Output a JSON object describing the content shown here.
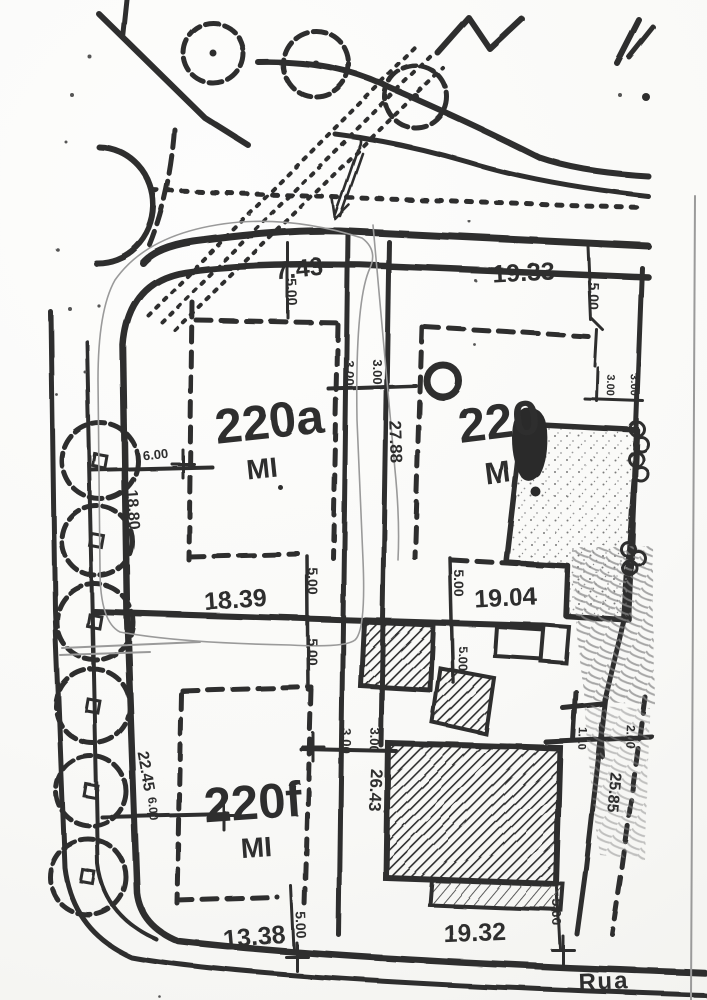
{
  "meta": {
    "document_type": "Scanned cadastral site plan",
    "street_label": "Rua"
  },
  "colors": {
    "ink": "#2f2f2f",
    "paper": "#f9f9f7",
    "pencil": "#9a9a9a"
  },
  "plots": [
    {
      "id": "220a",
      "zoning": "MI"
    },
    {
      "id": "220",
      "zoning": "M"
    },
    {
      "id": "220f",
      "zoning": "MI"
    }
  ],
  "dimensions_m": {
    "top_frontages": [
      "7.43",
      "19.33"
    ],
    "mid_frontages": [
      "18.39",
      "19.04"
    ],
    "bottom_frontages": [
      "13.38",
      "19.32"
    ],
    "left_boundary": [
      "18.80",
      "22.45"
    ],
    "road_centerline": [
      "27.88",
      "26.43"
    ],
    "right_side": [
      "25.85",
      "1.10",
      "2.00"
    ],
    "setbacks": [
      "5.00",
      "3.00",
      "6.00"
    ]
  },
  "labels": [
    {
      "name": "dim-7-43",
      "text": "7.43",
      "x": 300,
      "y": 277,
      "rot": -6,
      "size": 25
    },
    {
      "name": "dim-19-33",
      "text": "19.33",
      "x": 524,
      "y": 281,
      "rot": -3,
      "size": 25
    },
    {
      "name": "setback-5-00-top-left",
      "text": "5.00",
      "x": 287,
      "y": 292,
      "rot": 88,
      "size": 14
    },
    {
      "name": "setback-5-00-top-right",
      "text": "5.00",
      "x": 589,
      "y": 296,
      "rot": 92,
      "size": 14
    },
    {
      "name": "setback-3-00-top-a",
      "text": "3.00",
      "x": 345,
      "y": 373,
      "rot": 90,
      "size": 13
    },
    {
      "name": "setback-3-00-top-b",
      "text": "3.00",
      "x": 373,
      "y": 372,
      "rot": 90,
      "size": 13
    },
    {
      "name": "setback-3-00-right-a",
      "text": "3.00",
      "x": 607,
      "y": 385,
      "rot": 92,
      "size": 11
    },
    {
      "name": "setback-3-00-right-b",
      "text": "3.00",
      "x": 631,
      "y": 385,
      "rot": 92,
      "size": 11
    },
    {
      "name": "dim-27-88",
      "text": "27.88",
      "x": 390,
      "y": 442,
      "rot": 88,
      "size": 17
    },
    {
      "name": "dim-6-00-upper",
      "text": "6.00",
      "x": 156,
      "y": 459,
      "rot": -6,
      "size": 13
    },
    {
      "name": "dim-18-80",
      "text": "18.80",
      "x": 128,
      "y": 510,
      "rot": 86,
      "size": 16
    },
    {
      "name": "dim-18-39",
      "text": "18.39",
      "x": 236,
      "y": 608,
      "rot": -4,
      "size": 25
    },
    {
      "name": "dim-19-04",
      "text": "19.04",
      "x": 506,
      "y": 606,
      "rot": -3,
      "size": 25
    },
    {
      "name": "setback-5-00-mid-a",
      "text": "5.00",
      "x": 308,
      "y": 581,
      "rot": 90,
      "size": 14
    },
    {
      "name": "setback-5-00-mid-b",
      "text": "5.00",
      "x": 308,
      "y": 652,
      "rot": 90,
      "size": 14
    },
    {
      "name": "setback-5-00-mid-c",
      "text": "5.00",
      "x": 454,
      "y": 583,
      "rot": 90,
      "size": 14
    },
    {
      "name": "setback-5-00-mid-d",
      "text": "5.00",
      "x": 459,
      "y": 659,
      "rot": 90,
      "size": 13
    },
    {
      "name": "setback-3-00-low-a",
      "text": "3.00",
      "x": 342,
      "y": 741,
      "rot": 92,
      "size": 13
    },
    {
      "name": "setback-3-00-low-b",
      "text": "3.00",
      "x": 370,
      "y": 740,
      "rot": 92,
      "size": 13
    },
    {
      "name": "dim-26-43",
      "text": "26.43",
      "x": 370,
      "y": 790,
      "rot": 93,
      "size": 17
    },
    {
      "name": "dim-22-45",
      "text": "22.45",
      "x": 141,
      "y": 772,
      "rot": 80,
      "size": 16
    },
    {
      "name": "dim-6-00-lower",
      "text": "6.00",
      "x": 149,
      "y": 809,
      "rot": 85,
      "size": 12
    },
    {
      "name": "dim-1-10",
      "text": "1.10",
      "x": 578,
      "y": 738,
      "rot": 92,
      "size": 12
    },
    {
      "name": "dim-2-00",
      "text": "2.00",
      "x": 627,
      "y": 737,
      "rot": 92,
      "size": 12
    },
    {
      "name": "dim-25-85",
      "text": "25.85",
      "x": 609,
      "y": 792,
      "rot": 95,
      "size": 16
    },
    {
      "name": "dim-13-38",
      "text": "13.38",
      "x": 255,
      "y": 945,
      "rot": -5,
      "size": 25
    },
    {
      "name": "dim-19-32",
      "text": "19.32",
      "x": 475,
      "y": 941,
      "rot": -2,
      "size": 25
    },
    {
      "name": "setback-5-00-bot-left",
      "text": "5.00",
      "x": 296,
      "y": 925,
      "rot": 88,
      "size": 14
    },
    {
      "name": "setback-5-00-bot-right",
      "text": "5.00",
      "x": 552,
      "y": 912,
      "rot": 90,
      "size": 14
    },
    {
      "name": "plot-id-220a",
      "text": "220a",
      "x": 271,
      "y": 438,
      "rot": -6,
      "size": 49
    },
    {
      "name": "plot-zone-220a",
      "text": "MI",
      "x": 263,
      "y": 478,
      "rot": -6,
      "size": 28
    },
    {
      "name": "plot-id-220",
      "text": "220",
      "x": 501,
      "y": 438,
      "rot": -7,
      "size": 49
    },
    {
      "name": "plot-zone-220",
      "text": "M",
      "x": 499,
      "y": 483,
      "rot": -7,
      "size": 31
    },
    {
      "name": "plot-id-220f",
      "text": "220f",
      "x": 254,
      "y": 819,
      "rot": -4,
      "size": 49
    },
    {
      "name": "plot-zone-220f",
      "text": "MI",
      "x": 257,
      "y": 857,
      "rot": -4,
      "size": 28
    },
    {
      "name": "street-name",
      "text": "Rua",
      "x": 604,
      "y": 989,
      "rot": -2,
      "size": 24,
      "ls": 2
    }
  ],
  "trees": {
    "left_row": [
      [
        100,
        461,
        38
      ],
      [
        97,
        541,
        35
      ],
      [
        95,
        622,
        38
      ],
      [
        93,
        706,
        37
      ],
      [
        91,
        791,
        35
      ],
      [
        88,
        877,
        38
      ]
    ],
    "top_row": [
      [
        213,
        53,
        30
      ],
      [
        316,
        64,
        33
      ],
      [
        416,
        97,
        31
      ]
    ]
  },
  "fence_circles": [
    [
      637,
      429,
      7
    ],
    [
      641,
      444,
      7
    ],
    [
      636,
      459,
      7
    ],
    [
      641,
      474,
      7
    ],
    [
      628,
      549,
      7
    ],
    [
      638,
      558,
      7
    ],
    [
      630,
      568,
      7
    ]
  ]
}
